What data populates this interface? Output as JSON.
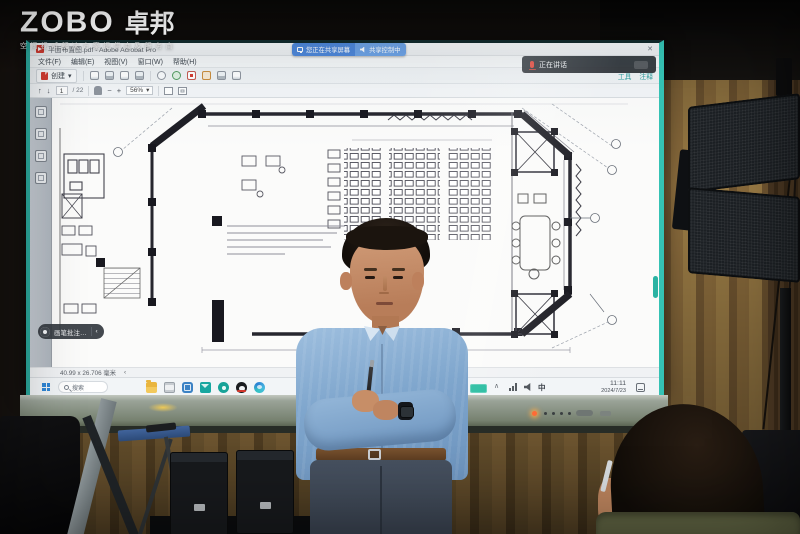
{
  "logo": {
    "brand_en": "ZOBO",
    "brand_cn": "卓邦",
    "tagline": "空间视听解决方案提供商及服务商"
  },
  "display": {
    "conference": {
      "sharing_label": "您正在共享屏幕",
      "sharing_control": "共享控制中",
      "speaking_label": "正在讲话"
    },
    "acrobat": {
      "title": "平面布置图.pdf - Adobe Acrobat Pro",
      "close": "✕",
      "menu": [
        {
          "label": "文件(F)"
        },
        {
          "label": "编辑(E)"
        },
        {
          "label": "视图(V)"
        },
        {
          "label": "窗口(W)"
        },
        {
          "label": "帮助(H)"
        }
      ],
      "create_label": "创建",
      "create_caret": "▾",
      "panel_tabs": [
        {
          "label": "工具"
        },
        {
          "label": "注释"
        }
      ],
      "nav_up": "↑",
      "nav_down": "↓",
      "page_current": "1",
      "page_total": "/ 22",
      "zoom_out": "−",
      "zoom_in": "+",
      "zoom_value": "56%",
      "zoom_caret": "▾",
      "floating_tool": {
        "label": "画笔批注…",
        "chevron": "‹"
      },
      "status_dimensions": "40.99 x 26.706 毫米",
      "status_chevron": "‹"
    },
    "windows_taskbar": {
      "search_label": "搜索",
      "ime": "中",
      "tray_caret": "∧",
      "time": "11:11",
      "date": "2024/7/23"
    }
  }
}
